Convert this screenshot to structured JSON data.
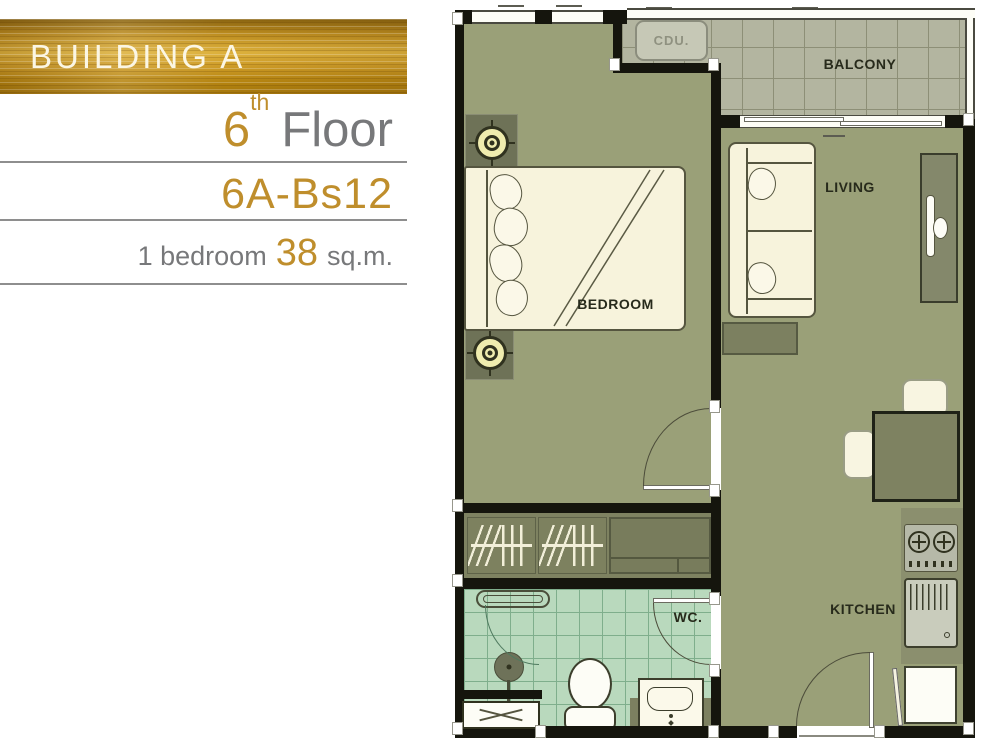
{
  "panel": {
    "building_label": "BUILDING A",
    "floor_number": "6",
    "floor_ordinal": "th",
    "floor_word": "Floor",
    "unit_code": "6A-Bs12",
    "bedrooms_text": "1 bedroom",
    "area_value": "38",
    "area_unit": "sq.m."
  },
  "floorplan": {
    "rooms": {
      "bedroom": "BEDROOM",
      "living": "LIVING",
      "balcony": "BALCONY",
      "kitchen": "KITCHEN",
      "wc": "WC.",
      "cdu": "CDU."
    }
  },
  "icons": {
    "ceiling_lamp_target": "css-concentric-circles-with-crosshair",
    "stove_burner": "css-circle-with-cross",
    "bath_mat_cross": "css-x-lines"
  },
  "colors": {
    "gold": "#bf8e2c",
    "text_gray": "#77787a",
    "banner_gold": "#cf9d28",
    "wall_black": "#15150d",
    "floor_olive": "#9aa078",
    "balcony_tile": "#b3b5a0",
    "wc_tile": "#b9d9bd",
    "furniture_cream": "#f7f3dc",
    "furniture_dark": "#7c8060"
  }
}
